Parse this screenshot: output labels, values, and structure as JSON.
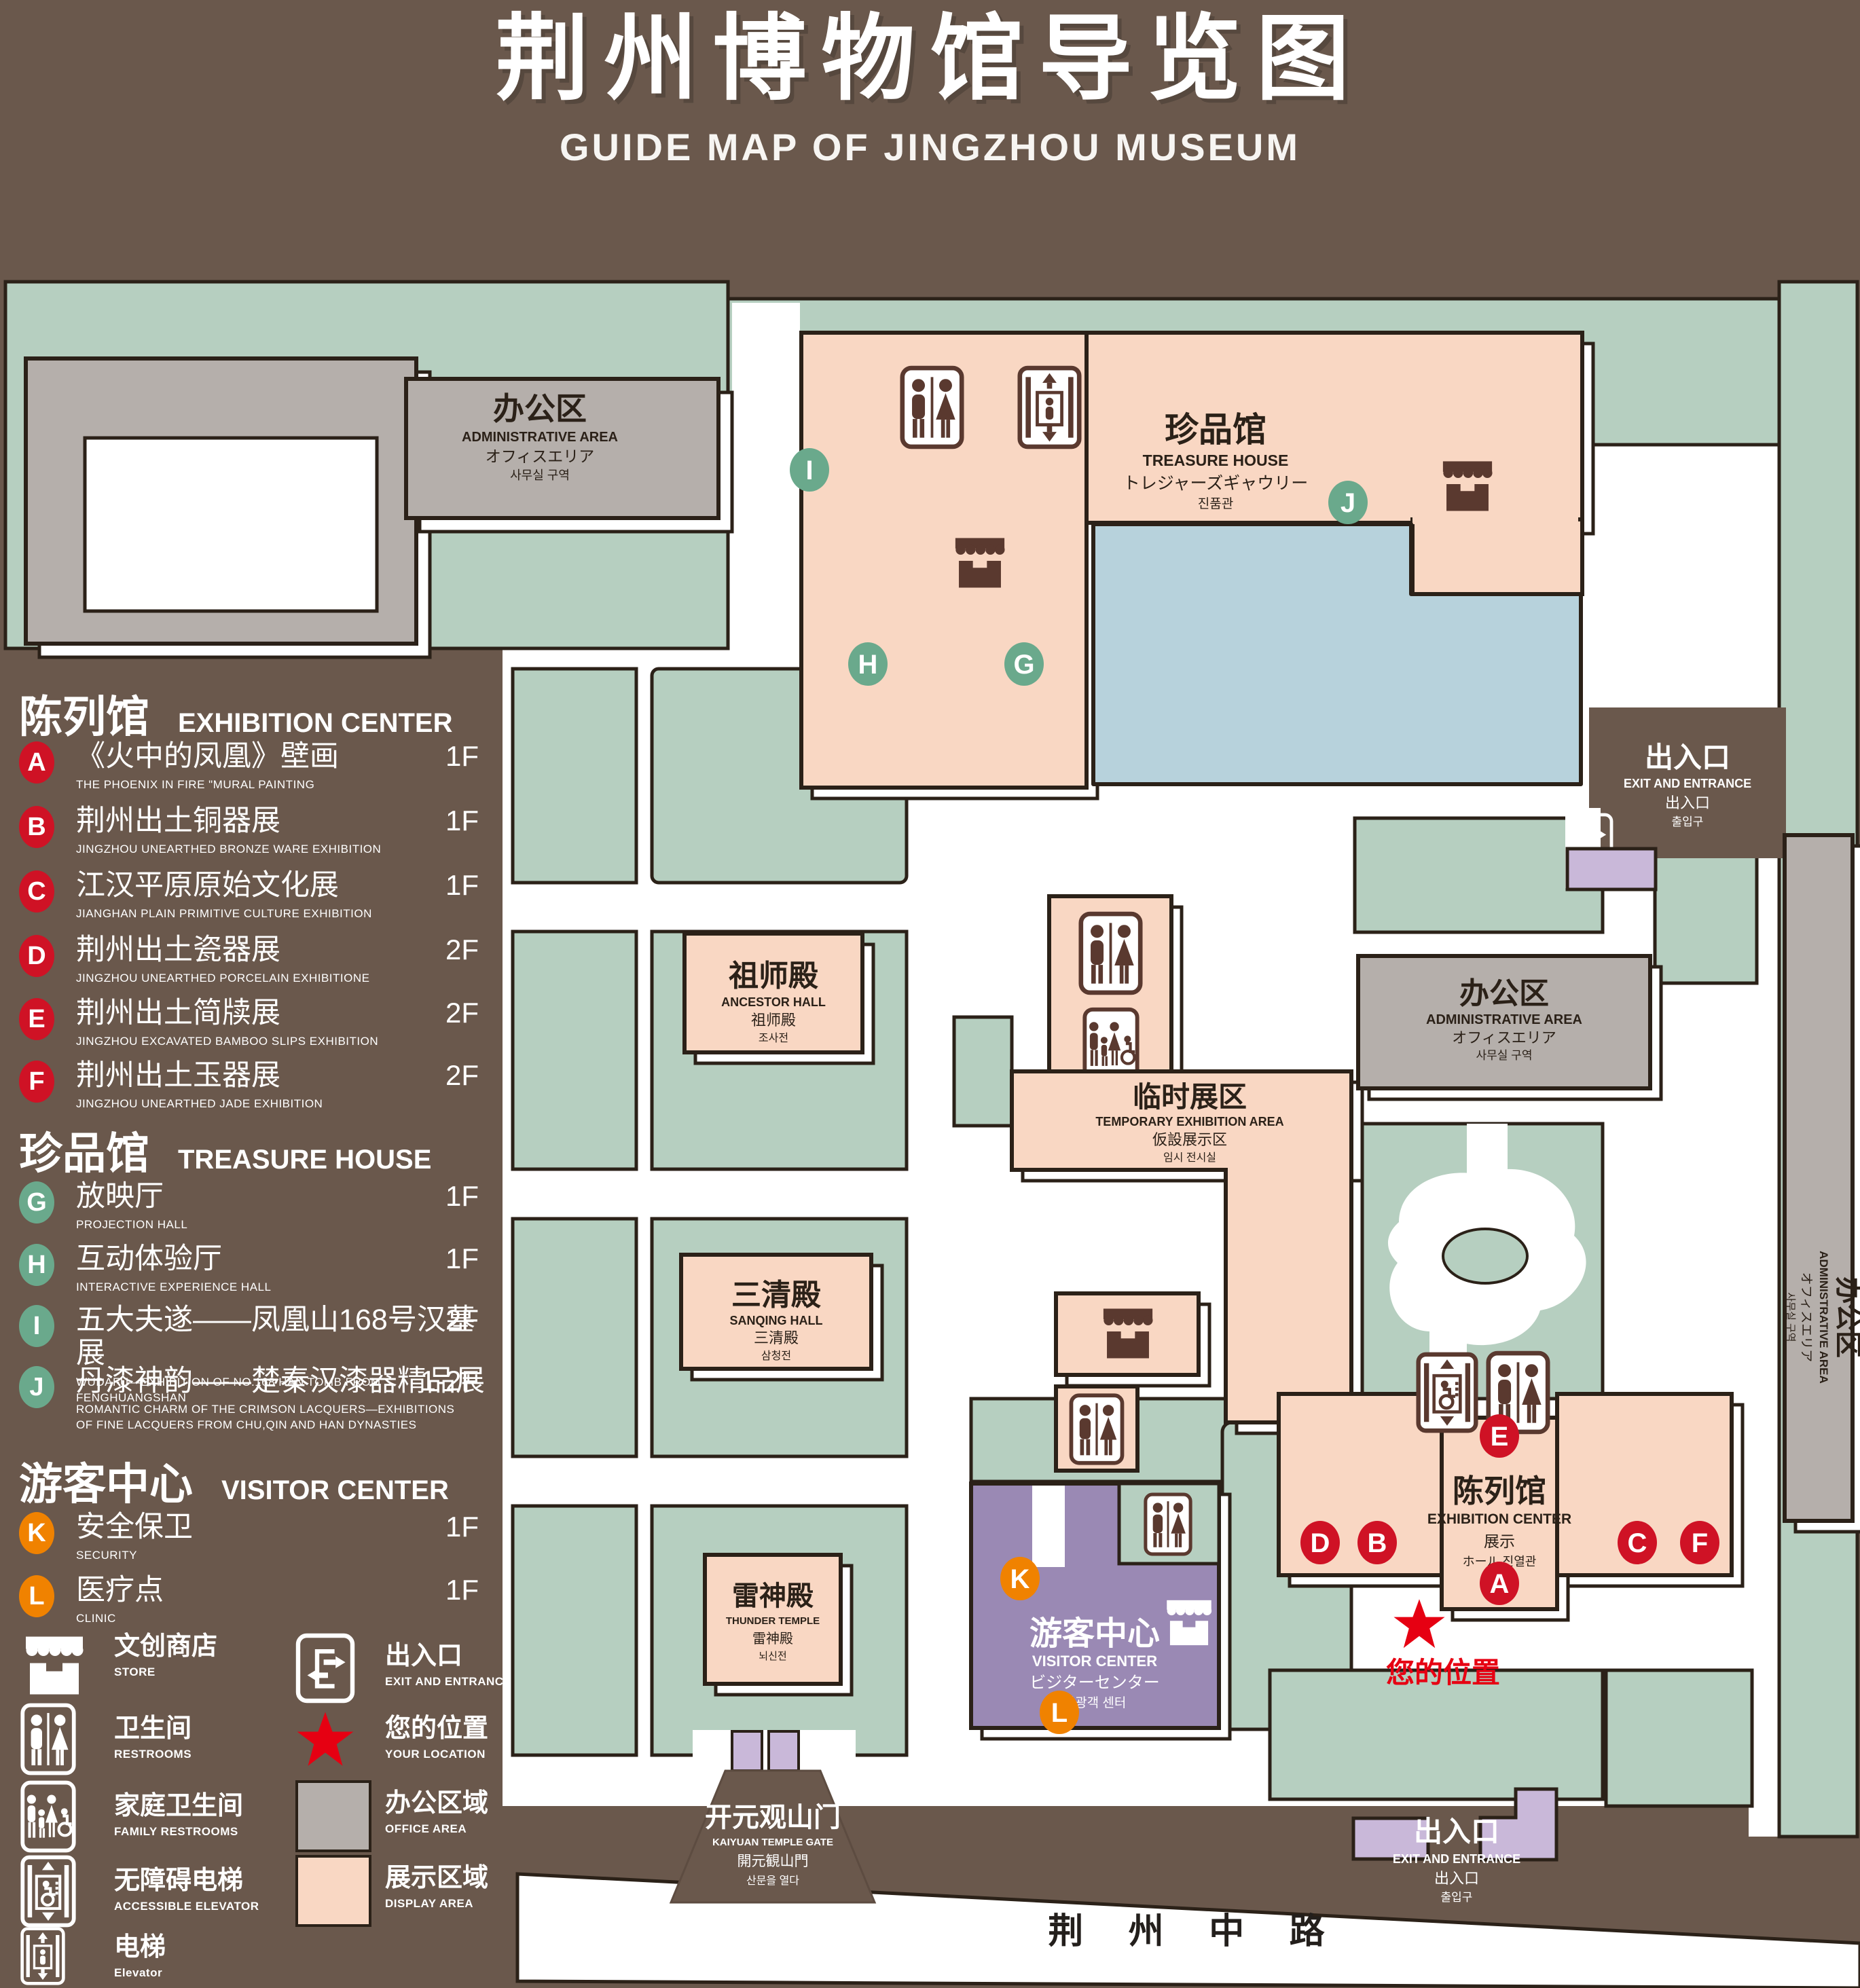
{
  "title": {
    "zh": "荆州博物馆导览图",
    "en": "GUIDE MAP OF JINGZHOU MUSEUM"
  },
  "colors": {
    "background": "#6a584c",
    "green_area": "#b6cfc0",
    "display_area": "#f9d7c3",
    "office_area": "#b5afab",
    "lake": "#b7d2dc",
    "visitor_center": "#9a89b4",
    "door": "#c9b8d9",
    "marker_red": "#cf1225",
    "marker_green": "#6aa98c",
    "marker_orange": "#f08200",
    "location_red": "#e60012",
    "line": "#2b2118"
  },
  "legend": {
    "sections": [
      {
        "zh": "陈列馆",
        "en": "EXHIBITION CENTER"
      },
      {
        "zh": "珍品馆",
        "en": "TREASURE HOUSE"
      },
      {
        "zh": "游客中心",
        "en": "VISITOR CENTER"
      }
    ],
    "items": [
      {
        "id": "A",
        "zh": "《火中的凤凰》壁画",
        "en": "THE PHOENIX IN FIRE \"MURAL PAINTING",
        "floor": "1F"
      },
      {
        "id": "B",
        "zh": "荆州出土铜器展",
        "en": "JINGZHOU UNEARTHED BRONZE WARE EXHIBITION",
        "floor": "1F"
      },
      {
        "id": "C",
        "zh": "江汉平原原始文化展",
        "en": "JIANGHAN PLAIN PRIMITIVE CULTURE EXHIBITION",
        "floor": "1F"
      },
      {
        "id": "D",
        "zh": "荆州出土瓷器展",
        "en": "JINGZHOU UNEARTHED PORCELAIN EXHIBITIONE",
        "floor": "2F"
      },
      {
        "id": "E",
        "zh": "荆州出土简牍展",
        "en": "JINGZHOU EXCAVATED BAMBOO SLIPS EXHIBITION",
        "floor": "2F"
      },
      {
        "id": "F",
        "zh": "荆州出土玉器展",
        "en": "JINGZHOU UNEARTHED JADE EXHIBITION",
        "floor": "2F"
      },
      {
        "id": "G",
        "zh": "放映厅",
        "en": "PROJECTION HALL",
        "floor": "1F"
      },
      {
        "id": "H",
        "zh": "互动体验厅",
        "en": "INTERACTIVE EXPERIENCE HALL",
        "floor": "1F"
      },
      {
        "id": "I",
        "zh": "五大夫遂——凤凰山168号汉墓展",
        "en": "WUDAFU—EXHIBITION OF NO.168 HAN TOMB FROM FENGHUANGSHAN",
        "floor": "2F"
      },
      {
        "id": "J",
        "zh": "丹漆神韵——楚秦汉漆器精品展",
        "en": "ROMANTIC CHARM OF THE CRIMSON LACQUERS—EXHIBITIONS OF FINE LACQUERS FROM CHU,QIN AND HAN DYNASTIES",
        "floor": "1-2F"
      },
      {
        "id": "K",
        "zh": "安全保卫",
        "en": "SECURITY",
        "floor": "1F"
      },
      {
        "id": "L",
        "zh": "医疗点",
        "en": "CLINIC",
        "floor": "1F"
      }
    ],
    "key": {
      "store": {
        "zh": "文创商店",
        "en": "STORE"
      },
      "exit": {
        "zh": "出入口",
        "en": "EXIT AND ENTRANCE"
      },
      "restrooms": {
        "zh": "卫生间",
        "en": "RESTROOMS"
      },
      "location": {
        "zh": "您的位置",
        "en": "YOUR LOCATION"
      },
      "family": {
        "zh": "家庭卫生间",
        "en": "FAMILY RESTROOMS"
      },
      "office": {
        "zh": "办公区域",
        "en": "OFFICE AREA"
      },
      "accessible": {
        "zh": "无障碍电梯",
        "en": "ACCESSIBLE ELEVATOR"
      },
      "display": {
        "zh": "展示区域",
        "en": "DISPLAY AREA"
      },
      "elevator": {
        "zh": "电梯",
        "en": "Elevator"
      }
    }
  },
  "map": {
    "admin_nw": {
      "zh": "办公区",
      "en": "ADMINISTRATIVE AREA",
      "jp": "オフィスエリア",
      "kr": "사무실 구역"
    },
    "treasure": {
      "zh": "珍品馆",
      "en": "TREASURE HOUSE",
      "jp": "トレジャーズギャウリー",
      "kr": "진품관"
    },
    "ancestor": {
      "zh": "祖师殿",
      "en": "ANCESTOR HALL",
      "jp": "祖师殿",
      "kr": "조사전"
    },
    "sanqing": {
      "zh": "三清殿",
      "en": "SANQING HALL",
      "jp": "三清殿",
      "kr": "삼청전"
    },
    "thunder": {
      "zh": "雷神殿",
      "en": "THUNDER TEMPLE",
      "jp": "雷神殿",
      "kr": "뇌신전"
    },
    "temporary": {
      "zh": "临时展区",
      "en": "TEMPORARY EXHIBITION AREA",
      "jp": "仮設展示区",
      "kr": "임시 전시실"
    },
    "admin_mid": {
      "zh": "办公区",
      "en": "ADMINISTRATIVE AREA",
      "jp": "オフィスエリア",
      "kr": "사무실 구역"
    },
    "admin_east": {
      "zh": "办公区",
      "en": "ADMINISTRATIVE AREA",
      "jp": "オフィスエリア",
      "kr": "사무실 구역"
    },
    "exhibition": {
      "zh": "陈列馆",
      "en": "EXHIBITION CENTER",
      "jp": "展示",
      "kr": "ホール 진열관"
    },
    "visitor": {
      "zh": "游客中心",
      "en": "VISITOR CENTER",
      "jp": "ビジターセンター",
      "kr": "관광객 센터"
    },
    "gate": {
      "zh": "开元观山门",
      "en": "KAIYUAN TEMPLE GATE",
      "jp": "開元観山門",
      "kr": "산문을 열다"
    },
    "exit_east": {
      "zh": "出入口",
      "en": "EXIT AND ENTRANCE",
      "jp": "出入口",
      "kr": "출입구"
    },
    "exit_south": {
      "zh": "出入口",
      "en": "EXIT AND ENTRANCE",
      "jp": "出入口",
      "kr": "출입구"
    },
    "road": "荆 州 中 路",
    "your_location": "您的位置"
  }
}
